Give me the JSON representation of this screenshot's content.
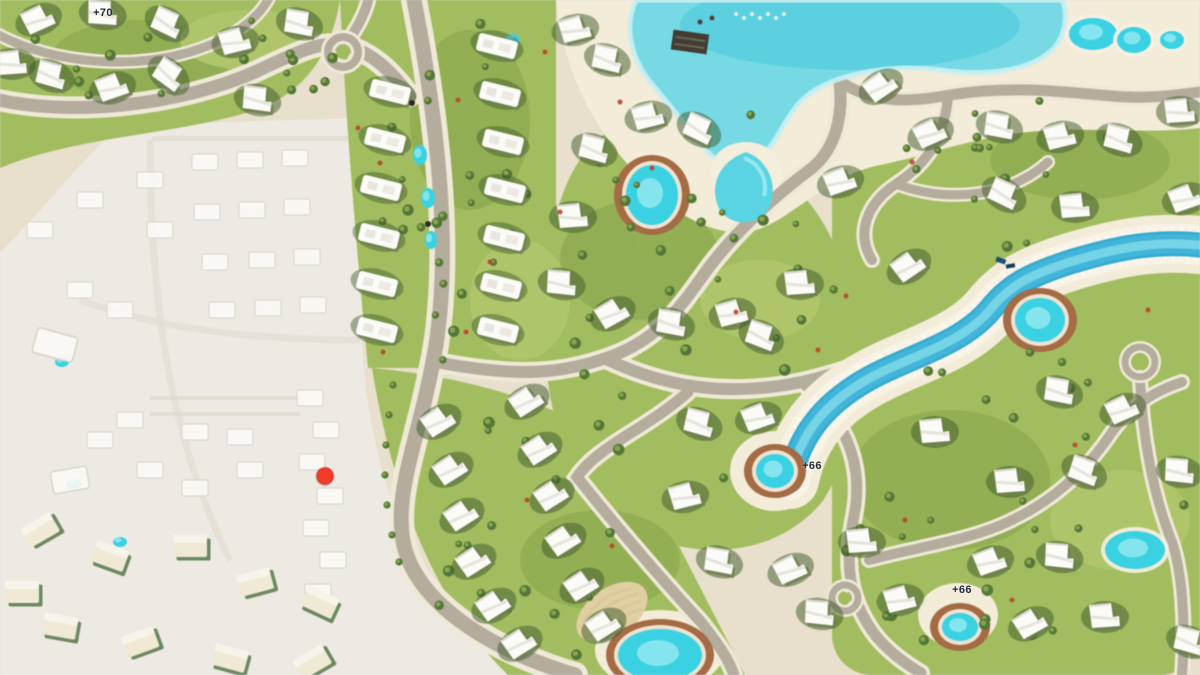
{
  "map": {
    "marker": {
      "x": 325,
      "y": 476,
      "color": "#f13a2a"
    },
    "elevation_labels": [
      {
        "text": "+70",
        "x": 103,
        "y": 13
      },
      {
        "text": "+66",
        "x": 812,
        "y": 466
      },
      {
        "text": "+66",
        "x": 962,
        "y": 590
      }
    ],
    "colors": {
      "sand": "#e8e0cd",
      "pale": "#edeae3",
      "beach": "#f2ecda",
      "lagoon": "#79d8e3",
      "lagoon_deep": "#4fc9db",
      "pool": "#3fd0e0",
      "river": "#45b4d8",
      "deck": "#a26b46",
      "road": "#b4ac9d",
      "road_casing": "#efe9d9",
      "green": "#a3bd62",
      "green_light": "#c3d380",
      "green_dark": "#7c9a47",
      "hedge": "#3f5a2c",
      "tree": "#55763a",
      "tree_light": "#8fae54",
      "villa": "#fbfbf8",
      "villa_shadow": "#707f52",
      "cream": "#efe9d6",
      "cream_shadow": "#5f7d55",
      "stripe": "#d9c89e",
      "label": "#232a36"
    }
  }
}
